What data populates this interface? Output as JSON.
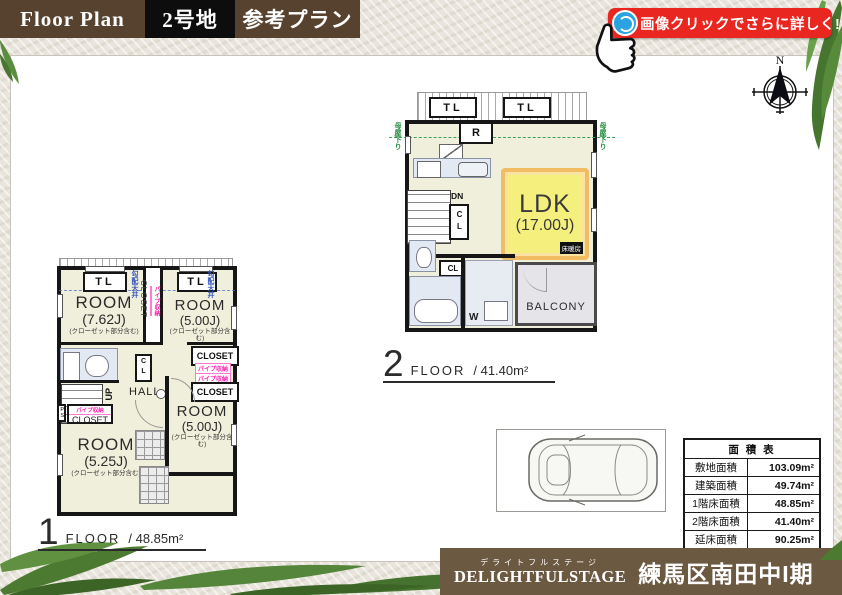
{
  "header": {
    "title": "Floor Plan",
    "lot": "2号地",
    "plan_type": "参考プラン"
  },
  "badge": {
    "label": "画像クリックでさらに詳しく!"
  },
  "compass": {
    "north": "N"
  },
  "floor2": {
    "number": "2",
    "floor_word": "FLOOR",
    "area": "/ 41.40m²",
    "ldk_name": "LDK",
    "ldk_size": "(17.00J)",
    "floor_heating": "床暖房",
    "balcony": "BALCONY",
    "refrigerator": "R",
    "down": "DN",
    "closet_abbr": "CL",
    "washer": "W",
    "top_light": "TL",
    "eaves_note": "母屋下り"
  },
  "floor1": {
    "number": "1",
    "floor_word": "FLOOR",
    "area": "/ 48.85m²",
    "rooms": [
      {
        "name": "ROOM",
        "size": "(7.62J)",
        "note": "(クローゼット部分含む)"
      },
      {
        "name": "ROOM",
        "size": "(5.00J)",
        "note": "(クローゼット部分含む)"
      },
      {
        "name": "ROOM",
        "size": "(5.00J)",
        "note": "(クローゼット部分含む)"
      },
      {
        "name": "ROOM",
        "size": "(5.25J)",
        "note": "(クローゼット部分含む)"
      }
    ],
    "hall": "HALL",
    "up": "UP",
    "ps": "PS",
    "closet_abbr": "CL",
    "closet": "CLOSET",
    "pipe_storage": "パイプ収納",
    "sloped_ceiling": "勾配天井",
    "top_light": "TL"
  },
  "area_table": {
    "title": "面 積 表",
    "rows": [
      {
        "label": "敷地面積",
        "value": "103.09m²"
      },
      {
        "label": "建築面積",
        "value": "49.74m²"
      },
      {
        "label": "1階床面積",
        "value": "48.85m²"
      },
      {
        "label": "2階床面積",
        "value": "41.40m²"
      },
      {
        "label": "延床面積",
        "value": "90.25m²"
      }
    ]
  },
  "footer": {
    "brand_ruby": "デライトフルステージ",
    "brand": "DELIGHTFULSTAGE",
    "project": "練馬区南田中I期"
  },
  "colors": {
    "header_brown": "#56422e",
    "badge_red": "#e9261f",
    "footer_brown": "#6c5941",
    "ldk_yellow": "#f5f07d",
    "plan_cream": "#f0efdb"
  }
}
